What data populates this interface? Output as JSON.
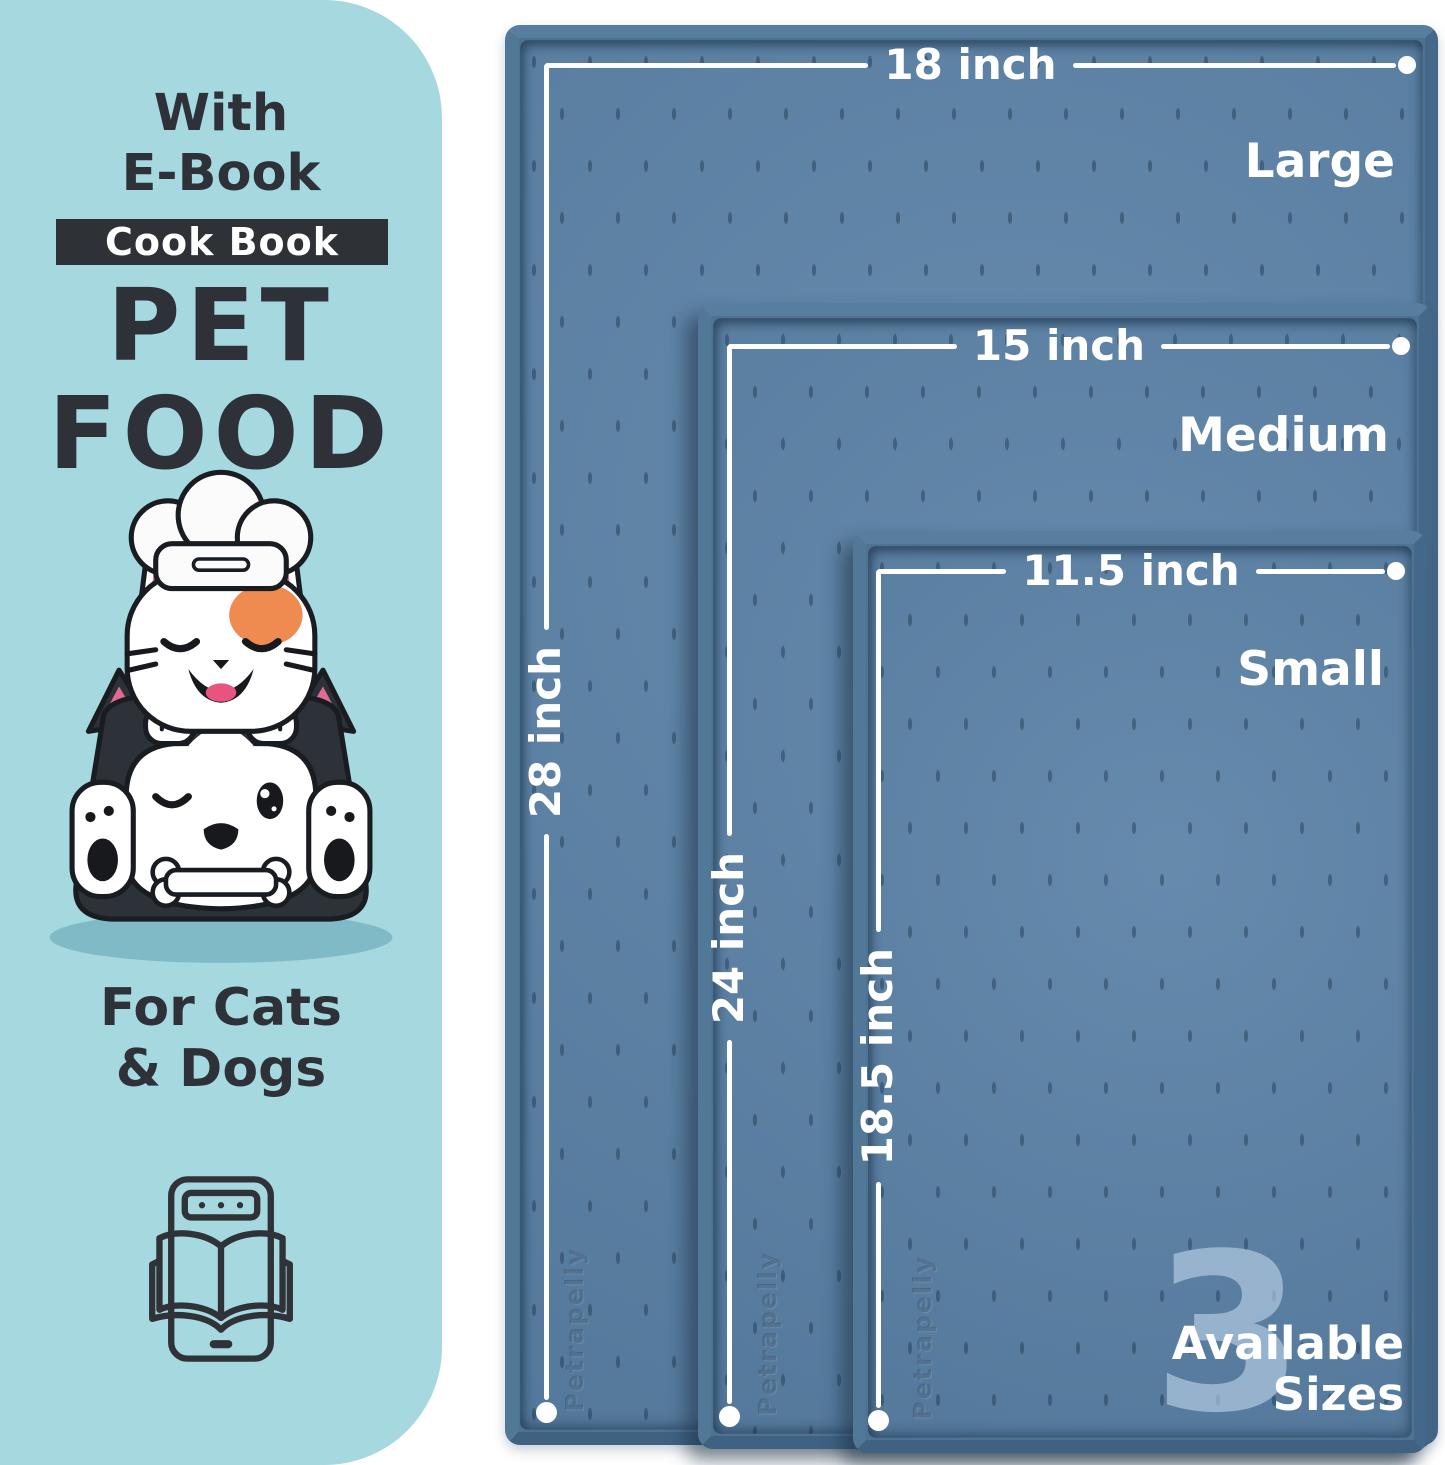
{
  "left_panel": {
    "bg_color": "#a5d8df",
    "text_color": "#2e3238",
    "title_line1": "With",
    "title_line2": "E-Book",
    "badge_label": "Cook Book",
    "heading_line1": "PET",
    "heading_line2": "FOOD",
    "subtitle_line1": "For Cats",
    "subtitle_line2": "& Dogs",
    "illustration_name": "chef-cat-on-husky-dog-with-bone",
    "icon_name": "e-book-tablet-open-book-icon"
  },
  "mats": {
    "surface_color": "#5d84a8",
    "rim_color": "#4c7294",
    "ruler_color": "#ffffff",
    "items": [
      {
        "size_name": "Large",
        "width_label": "18 inch",
        "height_label": "28 inch"
      },
      {
        "size_name": "Medium",
        "width_label": "15 inch",
        "height_label": "24 inch"
      },
      {
        "size_name": "Small",
        "width_label": "11.5 inch",
        "height_label": "18.5 inch"
      }
    ],
    "embossed_watermark": "Petrapelly"
  },
  "sizes_badge": {
    "number": "3",
    "line1": "Available",
    "line2": "Sizes"
  }
}
